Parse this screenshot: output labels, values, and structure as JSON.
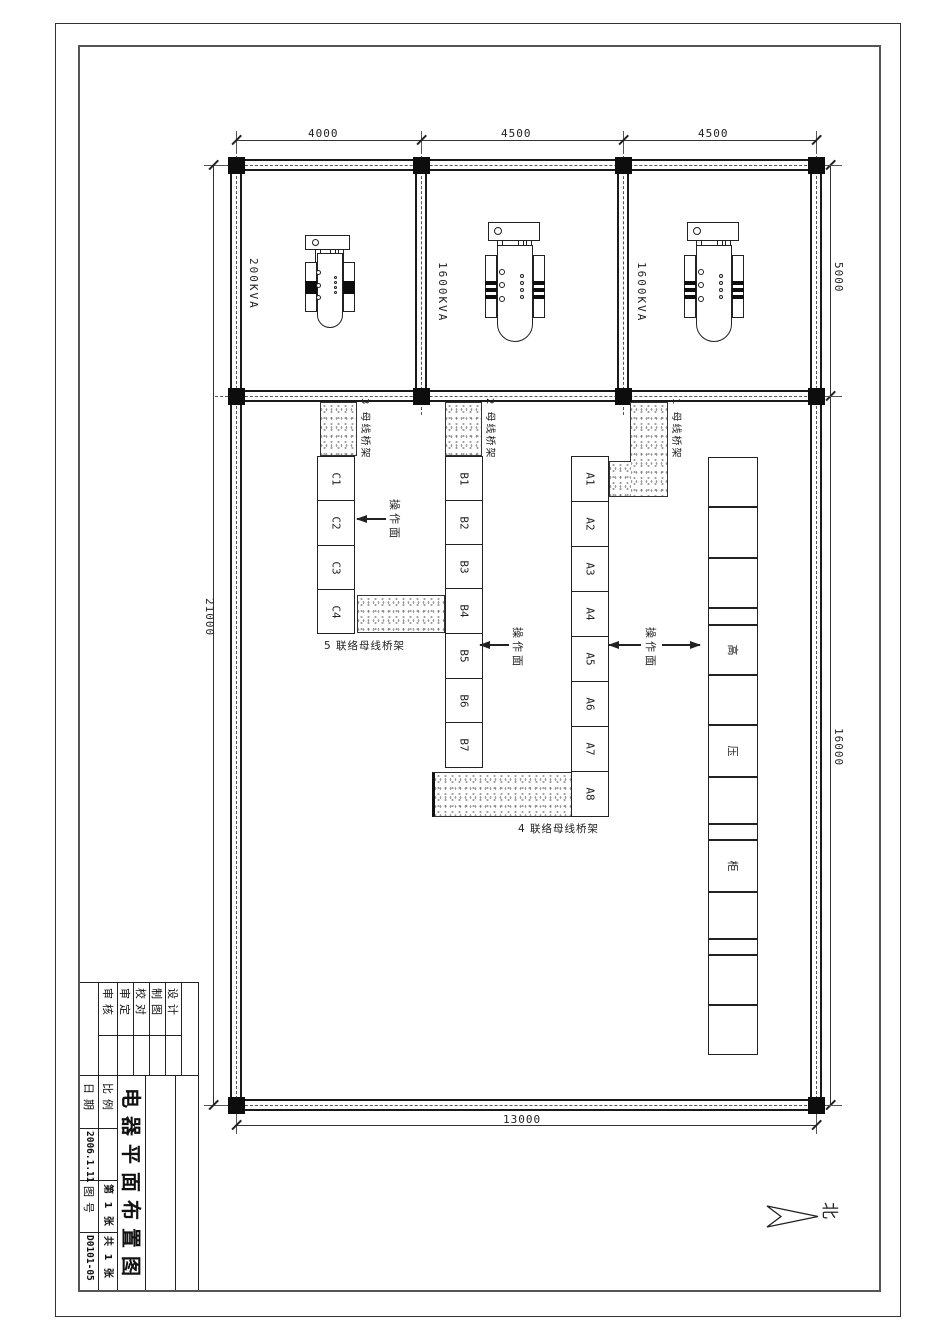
{
  "sheet": {
    "title": "电器平面布置图",
    "fields": {
      "design": "设计",
      "drafting": "制图",
      "proofread": "校对",
      "approve": "审定",
      "review": "审核",
      "scale_label": "比例",
      "scale_value": "",
      "date_label": "日期",
      "date_value": "2006.1.11",
      "drawing_no_label": "图号",
      "drawing_no_value": "D0101-05",
      "sheet_index": "第 1 张",
      "sheet_total": "共 1 张"
    }
  },
  "dimensions": {
    "top": [
      "4000",
      "4500",
      "4500"
    ],
    "left": "21000",
    "right_upper": "5000",
    "right_lower": "16000",
    "bottom": "13000"
  },
  "transformers": [
    {
      "label": "200KVA"
    },
    {
      "label": "1600KVA"
    },
    {
      "label": "1600KVA"
    }
  ],
  "rows": {
    "c": {
      "cells": [
        "C1",
        "C2",
        "C3",
        "C4"
      ]
    },
    "b": {
      "cells": [
        "B1",
        "B2",
        "B3",
        "B4",
        "B5",
        "B6",
        "B7"
      ]
    },
    "a": {
      "cells": [
        "A1",
        "A2",
        "A3",
        "A4",
        "A5",
        "A6",
        "A7",
        "A8"
      ]
    },
    "hv": {
      "chars": [
        "高",
        "压",
        "柜"
      ]
    }
  },
  "bridges": {
    "b1": "1 母线桥架",
    "b2": "2 母线桥架",
    "b3": "3 母线桥架",
    "b4": "4 联络母线桥架",
    "b5": "5 联络母线桥架"
  },
  "labels": {
    "operation_face": "操作面",
    "north": "北"
  }
}
